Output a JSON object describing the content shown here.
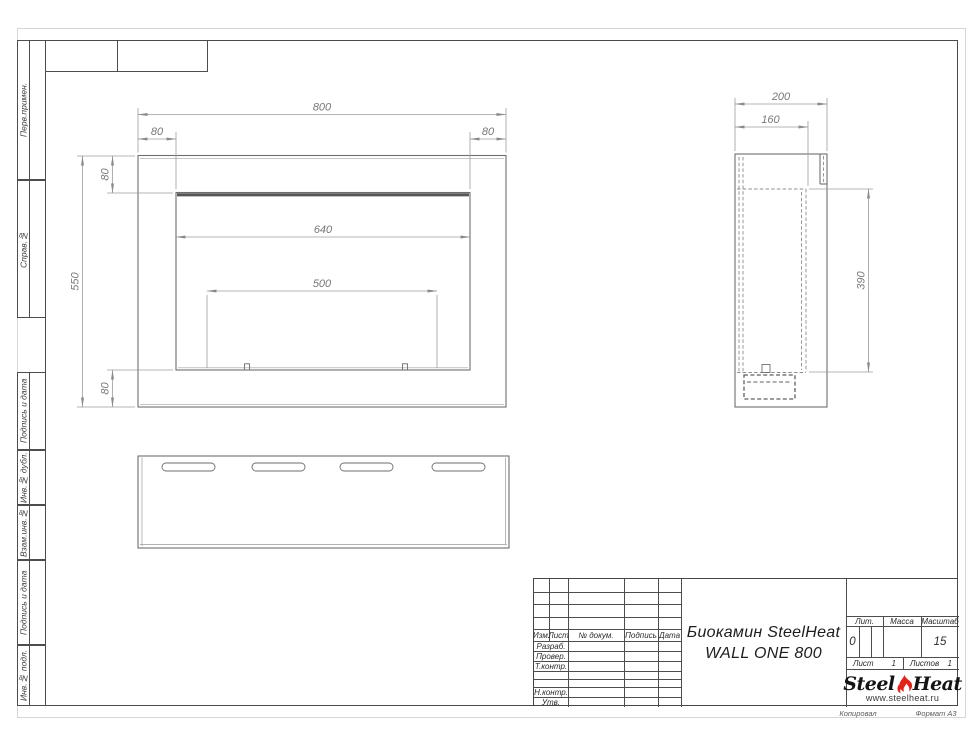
{
  "sheet": {
    "margin_labels": [
      "Перв.примен.",
      "Справ.№",
      "Подпись и дата",
      "Инв.№ дубл.",
      "Взам.инв.№",
      "Подпись и дата",
      "Инв.№ подл."
    ],
    "footer_left": "Копировал",
    "footer_right": "Формат А3"
  },
  "dims": {
    "front_width": "800",
    "front_flange_left": "80",
    "front_flange_right": "80",
    "front_flange_top": "80",
    "front_opening": "640",
    "front_burner": "500",
    "front_height": "550",
    "front_flange_bottom": "80",
    "side_depth": "200",
    "side_inner_depth": "160",
    "side_inner_height": "390"
  },
  "title_block": {
    "change_header": [
      "Изм.",
      "Лист",
      "№ докум.",
      "Подпись",
      "Дата"
    ],
    "sign_rows": [
      "Разраб.",
      "Провер.",
      "Т.контр.",
      "Н.контр.",
      "Утв."
    ],
    "doc_title_line1": "Биокамин SteelHeat",
    "doc_title_line2": "WALL ONE 800",
    "lit_label": "Лит.",
    "lit_value": "0",
    "mass_label": "Масса",
    "scale_label": "Масштаб",
    "scale_value": "15",
    "sheet_label": "Лист",
    "sheet_value": "1",
    "sheets_label": "Листов",
    "sheets_value": "1",
    "logo_steel": "Steel",
    "logo_heat": "Heat",
    "logo_url": "www.steelheat.ru"
  }
}
